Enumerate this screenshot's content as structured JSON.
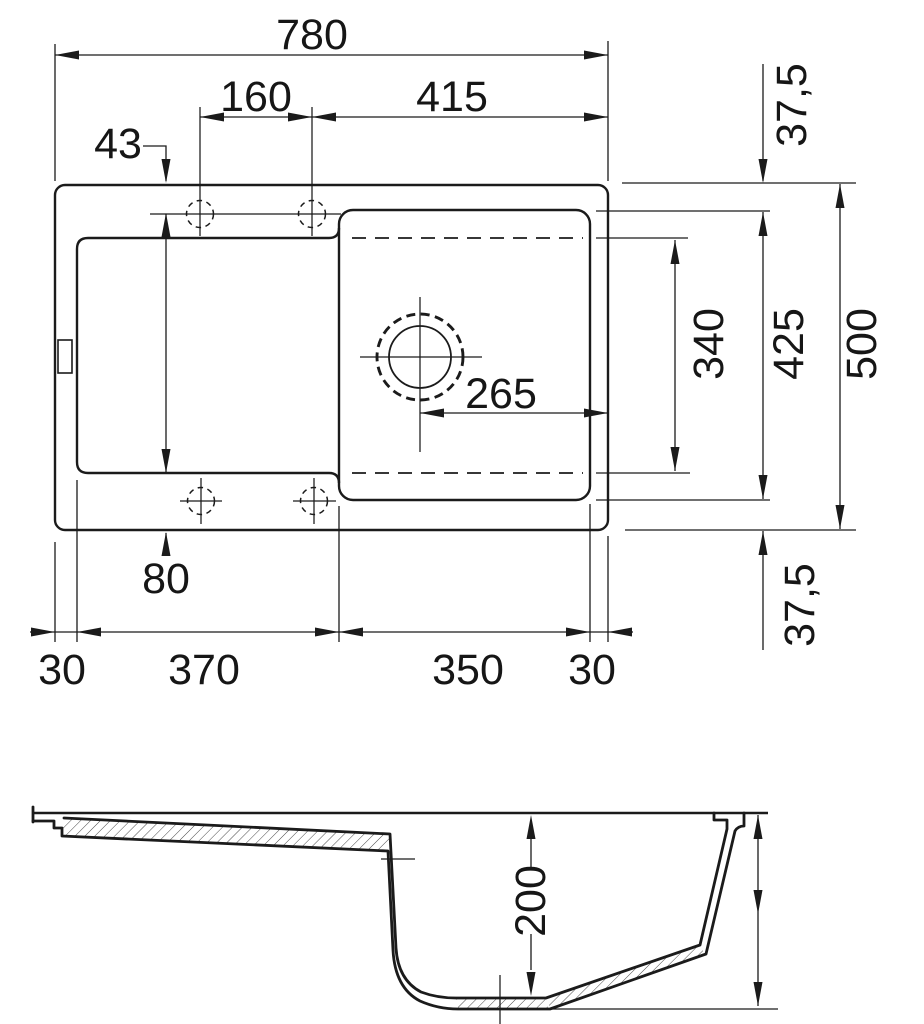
{
  "ink_color": "#1b1b1b",
  "dimensions": {
    "top": {
      "overall_width": "780",
      "tap_hole_spacing": "160",
      "edge_to_bowl": "415",
      "tap_hole_offset": "43",
      "drain_to_edge": "265",
      "drainboard_to_edge": "80",
      "left_margin": "30",
      "drainboard_width": "370",
      "bowl_width": "350",
      "right_margin": "30",
      "rim_top": "37,5",
      "bowl_length": "340",
      "cutout_length": "425",
      "overall_depth": "500",
      "rim_bottom": "37,5"
    },
    "section": {
      "bowl_depth": "200"
    }
  }
}
